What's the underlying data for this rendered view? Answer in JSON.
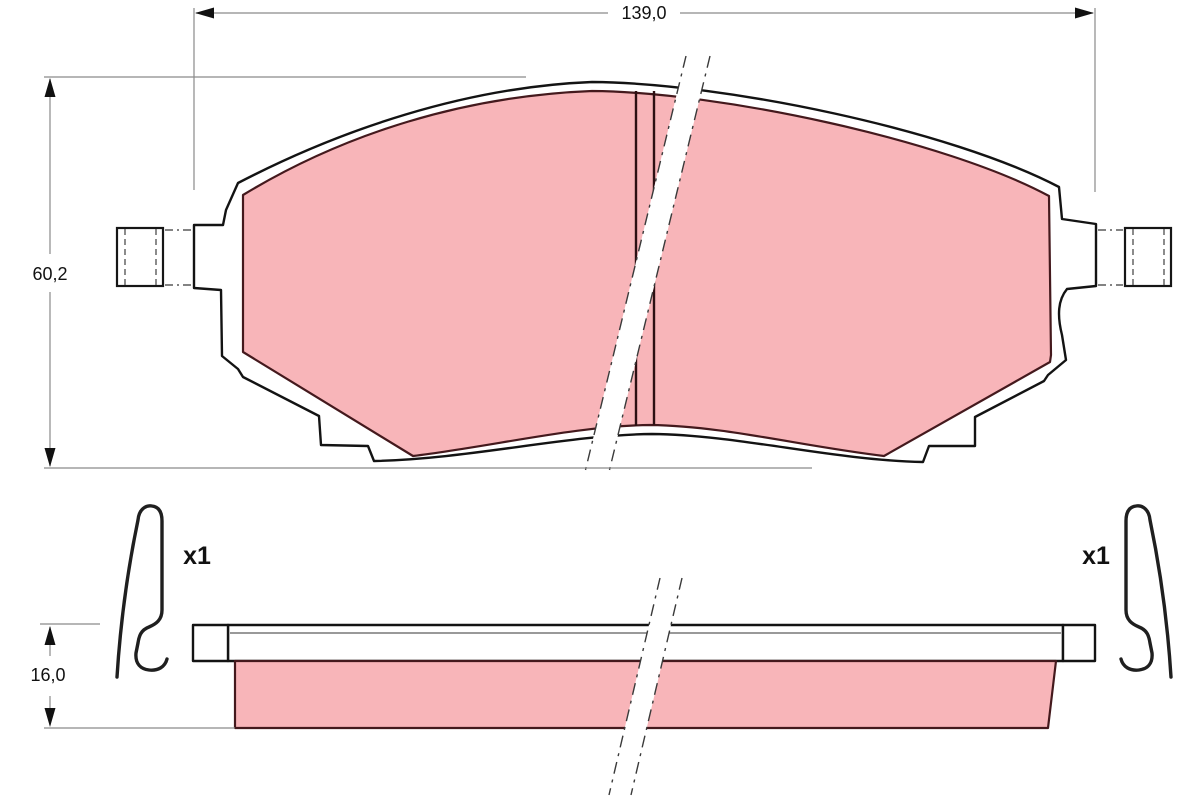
{
  "labels": {
    "dim_width": "139,0",
    "dim_height": "60,2",
    "dim_thickness": "16,0",
    "clip_left_qty": "x1",
    "clip_right_qty": "x1"
  },
  "colors": {
    "background": "#ffffff",
    "friction_fill": "#f8b5b9",
    "friction_outline": "#44191d",
    "plate_outline": "#131313",
    "dimension_line": "#8a8a8a",
    "text": "#111111"
  }
}
